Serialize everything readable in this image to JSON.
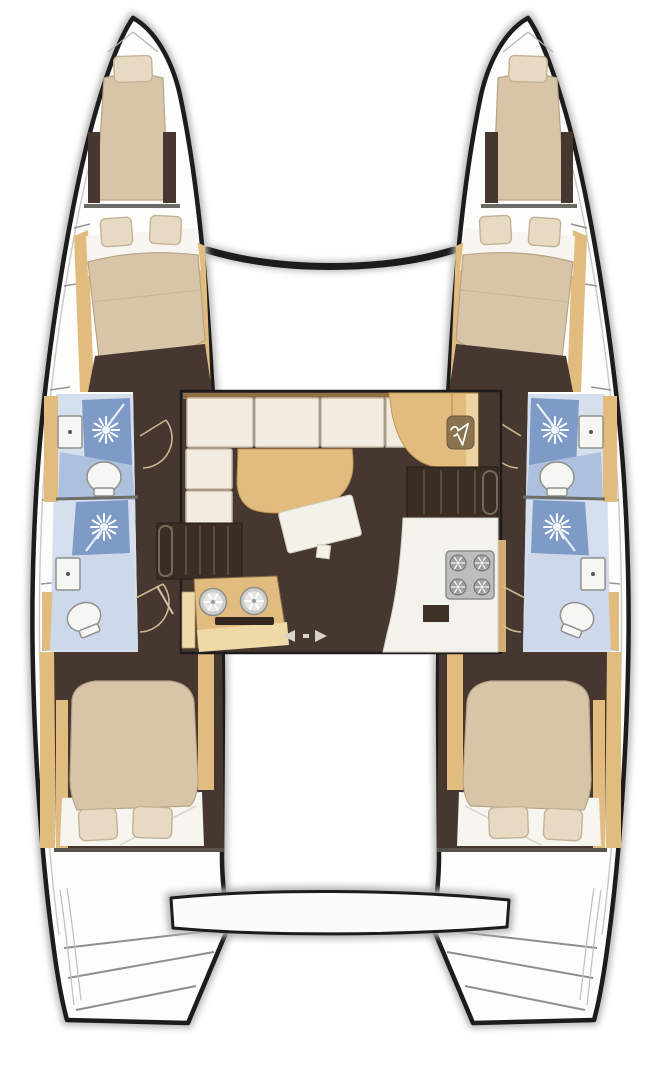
{
  "title": "Catamaran yacht interior floor plan (top view)",
  "colors": {
    "background": "#ffffff",
    "hull_outline": "#1c1c1c",
    "hull_shadow": "#b2b2af",
    "deck_white": "#fdfdfc",
    "deck_line": "#c9c9c4",
    "wood_tan": "#e2bc7f",
    "wood_tan_dark": "#c09550",
    "wood_tan_light": "#eed9a7",
    "upholstery_cream": "#d8c5a8",
    "upholstery_edge": "#b5a487",
    "pillow_cream": "#e8d9c2",
    "pillow_edge": "#c3b295",
    "linen_white": "#f7f5f0",
    "cabin_floor_brown": "#463730",
    "stair_brown": "#3a2d24",
    "step_line": "#5e4a3b",
    "shower_blue": "#7e9ac7",
    "bath_blue": "#adc0de",
    "bath_blue_pale": "#d6dfee",
    "fixture_white": "#f6f6f3",
    "fixture_stroke": "#90908c",
    "stove_gray": "#bdbebc",
    "burner_gray": "#9fa09e",
    "cushion_cream": "#f1ecdf",
    "cushion_edge": "#c6bca6",
    "table_white": "#f4f1e9",
    "arrow_gray": "#d8d4ca",
    "locker_olive": "#8a7450",
    "door_swing": "#c9b88f",
    "divider_gray": "#6e6e68",
    "window_tick": "#97978f"
  },
  "vessel": {
    "type": "sailing catamaran, twin hulls, bird's-eye interior layout",
    "cabins": 4,
    "heads": 4,
    "showers": 4,
    "forepeak_berths": 2,
    "hull_sections_bow_to_stern": [
      "forepeak berth with single pillow",
      "forward double cabin (two pillows, head forward)",
      "forward head: shower stall, sink, toilet",
      "aft head: shower stall, sink, toilet",
      "aft double cabin (two pillows, head aft)",
      "transom steps"
    ],
    "saloon_features": [
      "L-shaped sofa (6 cushions)",
      "curved dining table",
      "tilted coffee table",
      "navigation cabinet",
      "hanging locker",
      "companionway stairs to port hull",
      "companionway stairs to starboard hull",
      "galley unit with twin round sinks and drawer slot",
      "galley counter with 4-burner stove and appliance",
      "sliding cockpit door"
    ],
    "structure": [
      "forward crossbeam between bows",
      "aft transom beam between sterns"
    ]
  },
  "icons": {
    "shower": "sunburst rays",
    "hanging_locker": "clothes hanger",
    "stove": "four burner circles with spokes",
    "galley_sinks": "two spoked circles over drawer slot",
    "cockpit_door": "left and right arrows"
  }
}
